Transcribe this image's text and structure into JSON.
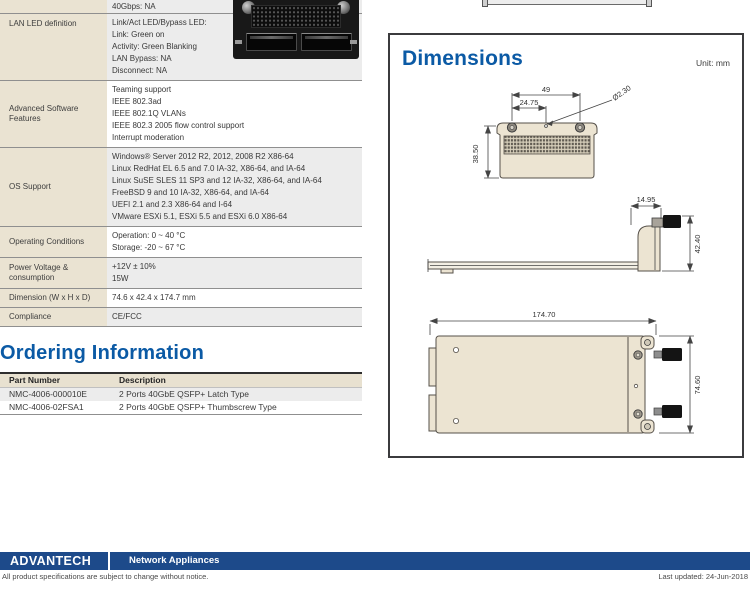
{
  "spec_table": {
    "rows": [
      {
        "label": "",
        "values": [
          "40Gbps: NA"
        ]
      },
      {
        "label": "LAN LED definition",
        "values": [
          "Link/Act LED/Bypass LED:",
          "Link: Green on",
          "Activity: Green Blanking",
          "LAN Bypass: NA",
          "Disconnect: NA"
        ]
      },
      {
        "label": "Advanced Software Features",
        "values": [
          "Teaming support",
          "IEEE 802.3ad",
          "IEEE 802.1Q VLANs",
          "IEEE 802.3 2005 flow control support",
          "Interrupt moderation"
        ]
      },
      {
        "label": "OS Support",
        "values": [
          "Windows® Server 2012 R2, 2012, 2008 R2 X86-64",
          "Linux RedHat EL 6.5 and 7.0 IA-32, X86-64, and IA-64",
          "Linux SuSE SLES 11 SP3 and 12 IA-32, X86-64, and IA-64",
          "FreeBSD 9 and 10 IA-32, X86-64, and IA-64",
          "UEFI 2.1 and 2.3 X86-64 and I-64",
          "VMware ESXi 5.1, ESXi 5.5 and ESXi 6.0 X86-64"
        ]
      },
      {
        "label": "Operating Conditions",
        "values": [
          "Operation: 0 ~ 40 °C",
          "Storage: -20 ~ 67 °C"
        ]
      },
      {
        "label": "Power Voltage & consumption",
        "values": [
          "+12V ± 10%",
          "15W"
        ]
      },
      {
        "label": "Dimension (W x H x D)",
        "values": [
          "74.6 x 42.4 x 174.7 mm"
        ]
      },
      {
        "label": "Compliance",
        "values": [
          "CE/FCC"
        ]
      }
    ]
  },
  "ordering": {
    "title": "Ordering Information",
    "headers": [
      "Part Number",
      "Description"
    ],
    "rows": [
      [
        "NMC-4006-000010E",
        "2 Ports 40GbE QSFP+ Latch Type"
      ],
      [
        "NMC-4006-02FSA1",
        "2 Ports 40GbE QSFP+ Thumbscrew Type"
      ]
    ]
  },
  "dimensions": {
    "title": "Dimensions",
    "unit": "Unit: mm",
    "front": {
      "width": "49",
      "offset": "24.75",
      "hole": "Ø2.30",
      "height": "38.50"
    },
    "side": {
      "depth": "14.95",
      "height": "42.40"
    },
    "top": {
      "length": "174.70",
      "width": "74.60"
    }
  },
  "footer": {
    "brand": "ADVANTECH",
    "series": "Network Appliances",
    "disclaimer": "All product specifications are subject to change without notice.",
    "last_updated": "Last updated: 24-Jun-2018"
  },
  "colors": {
    "heading_blue": "#0b5aa5",
    "footer_blue": "#1d4a8a",
    "label_beige": "#eae3d2",
    "stripe_gray": "#ececec",
    "drawing_beige": "#ece4d2"
  }
}
